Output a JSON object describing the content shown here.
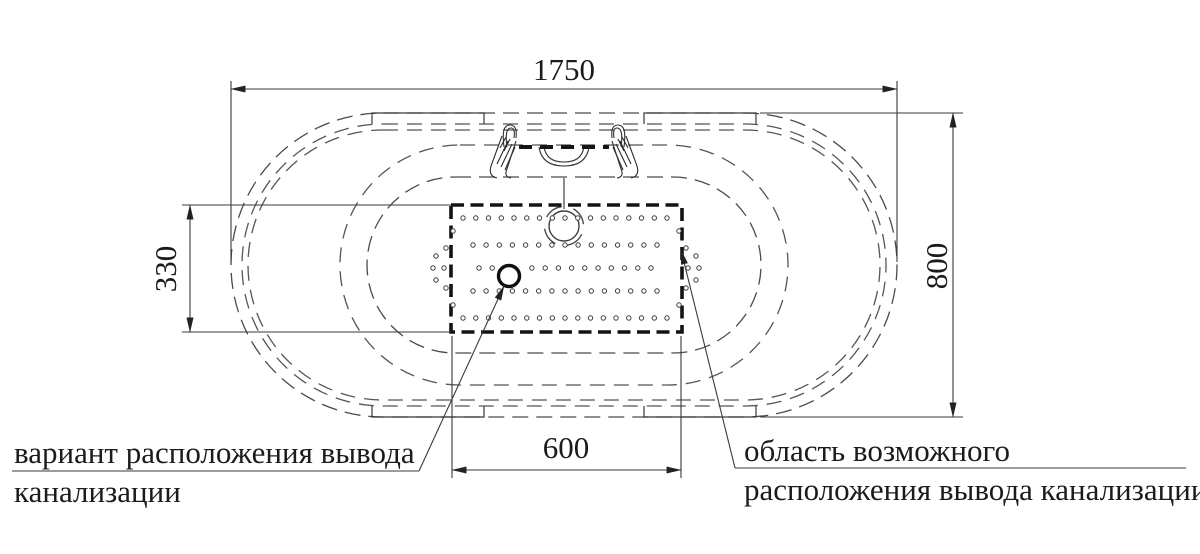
{
  "drawing": {
    "type": "bathtub-top-view-installation-drawing",
    "dimensions": {
      "overall_length": "1750",
      "overall_width": "800",
      "outlet_zone_height": "330",
      "outlet_zone_width": "600"
    },
    "labels": {
      "drain_variant_line1": "вариант расположения вывода",
      "drain_variant_line2": "канализации",
      "drain_area_line1": "область возможного",
      "drain_area_line2": "расположения вывода канализации"
    },
    "colors": {
      "background": "#ffffff",
      "outline": "#4a4a4a",
      "bold_outline": "#131313",
      "text": "#1b1b1b"
    }
  }
}
